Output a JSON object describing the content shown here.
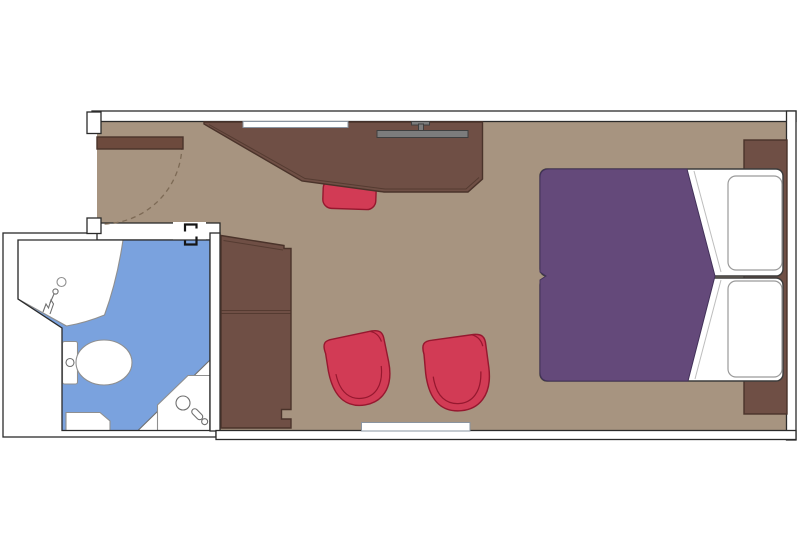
{
  "plan": {
    "type": "cruise-cabin-floor-plan",
    "rooms": [
      {
        "id": "main-cabin",
        "floor_color": "#a79480"
      },
      {
        "id": "bathroom",
        "floor_color": "#7aa2de"
      }
    ],
    "furniture": [
      "entry-door",
      "door-swing-arc",
      "wardrobe",
      "desk",
      "desk-stool",
      "tv",
      "mirror-strip",
      "window-strip",
      "double-bed",
      "blanket",
      "pillow-top",
      "pillow-bottom",
      "headboard-shelf",
      "tub-chair-left",
      "tub-chair-right",
      "washbasin-counter",
      "basin-faucet",
      "toilet",
      "bathroom-cabinet",
      "shower",
      "bathroom-door-hinges"
    ]
  },
  "colors": {
    "floor": "#a79480",
    "bath_floor": "#7aa2de",
    "wood": "#6f4f45",
    "door_wood": "#6d4a3d",
    "blanket": "#64497a",
    "chair_red": "#d23b55",
    "tv_gray": "#7c7c7c",
    "mirror_blue": "#dde7f5",
    "window_blue": "#ccd9e6",
    "fixture_white": "#ffffff"
  }
}
